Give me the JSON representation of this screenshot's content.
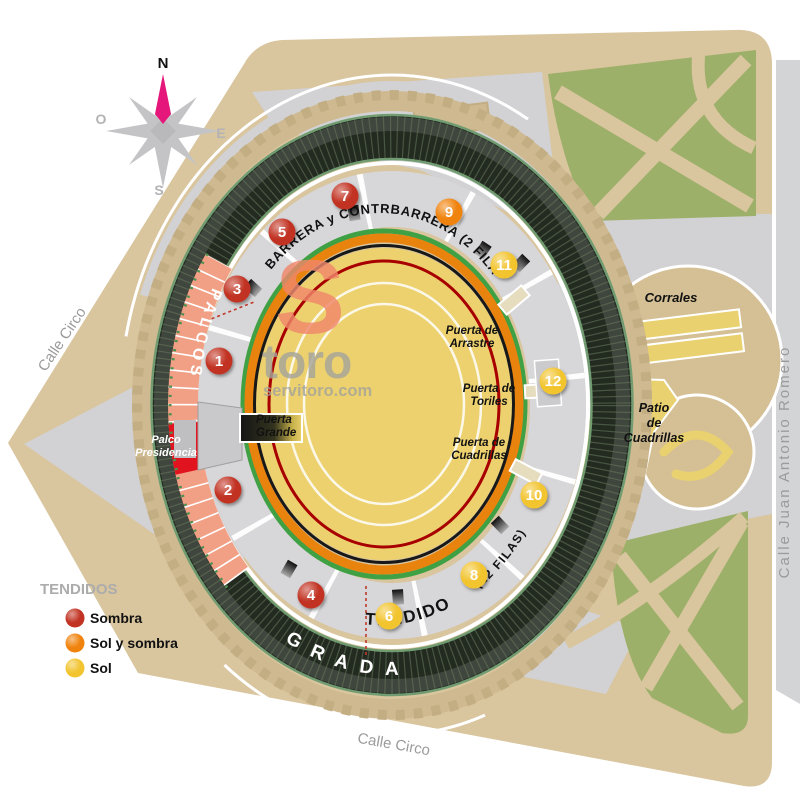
{
  "compass": {
    "n": "N",
    "e": "E",
    "s": "S",
    "o": "O"
  },
  "streets": {
    "left": "Calle Circo",
    "bottom": "Calle Circo",
    "right": "Calle Juan Antonio Romero"
  },
  "logo": {
    "initial": "S",
    "name": "toro",
    "domain": "servitoro.com"
  },
  "ring": {
    "palcos": "PALCOS",
    "gradas": "G R A D A S",
    "barrera": "BARRERA y CONTRBARRERA (2 FILAS)",
    "tendido": "TENDIDO",
    "tendido_filas": "(12 FILAS)",
    "presidencia_l1": "Palco",
    "presidencia_l2": "Presidencia"
  },
  "gates": {
    "grande": {
      "l1": "Puerta",
      "l2": "Grande"
    },
    "arrastre": {
      "l1": "Puerta de",
      "l2": "Arrastre"
    },
    "toriles": {
      "l1": "Puerta de",
      "l2": "Toriles"
    },
    "cuadrillas": {
      "l1": "Puerta de",
      "l2": "Cuadrillas"
    }
  },
  "areas": {
    "corrales": "Corrales",
    "patio_l1": "Patio",
    "patio_l2": "de",
    "patio_l3": "Cuadrillas"
  },
  "sections": [
    {
      "num": "1",
      "type": "sombra",
      "color": "#C13222"
    },
    {
      "num": "2",
      "type": "sombra",
      "color": "#C13222"
    },
    {
      "num": "3",
      "type": "sombra",
      "color": "#C13222"
    },
    {
      "num": "4",
      "type": "sombra",
      "color": "#C13222"
    },
    {
      "num": "5",
      "type": "sombra",
      "color": "#C13222"
    },
    {
      "num": "6",
      "type": "sol",
      "color": "#F2C42F"
    },
    {
      "num": "7",
      "type": "sombra",
      "color": "#C13222"
    },
    {
      "num": "8",
      "type": "sol",
      "color": "#F2C42F"
    },
    {
      "num": "9",
      "type": "sol-y-sombra",
      "color": "#F0830D"
    },
    {
      "num": "10",
      "type": "sol",
      "color": "#F2C42F"
    },
    {
      "num": "11",
      "type": "sol",
      "color": "#F2C42F"
    },
    {
      "num": "12",
      "type": "sol",
      "color": "#F2C42F"
    }
  ],
  "legend": {
    "title": "TENDIDOS",
    "items": [
      {
        "label": "Sombra",
        "color": "#C13222"
      },
      {
        "label": "Sol y sombra",
        "color": "#F0830D"
      },
      {
        "label": "Sol",
        "color": "#F2C42F"
      }
    ]
  },
  "colors": {
    "arena_sand": "#ECD16E",
    "park_green": "#9DB069",
    "block_tan": "#D9C59E",
    "palcos_salmon": "#F2A085",
    "presidencia_red": "#E1131E",
    "needle_pink": "#E6177B"
  }
}
